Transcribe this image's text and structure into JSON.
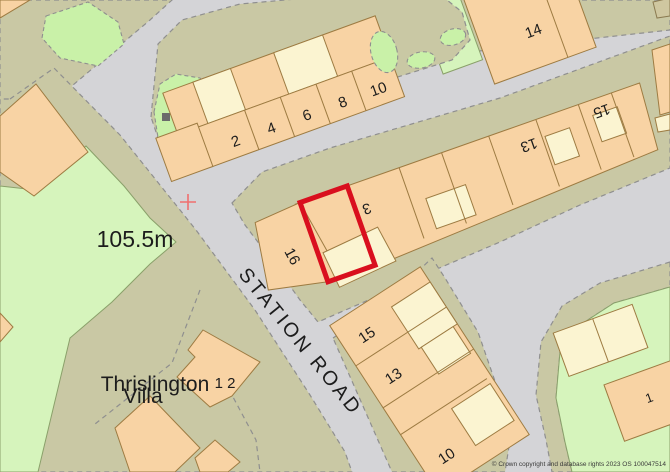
{
  "map": {
    "labels": {
      "top_terrace": [
        "2",
        "4",
        "6",
        "8",
        "10"
      ],
      "building_14": "14",
      "middle_terrace": {
        "n16": "16",
        "n3": "3",
        "n13": "13",
        "n15": "15"
      },
      "bottom_terrace": [
        "15",
        "13",
        "10"
      ],
      "right_building_1": "1",
      "spot_height": "105.5m",
      "villa_line1": "Thrislington",
      "villa_line2": "Villa",
      "building_12": "1 2",
      "road_name": "STATION ROAD",
      "copyright": "© Crown copyright and database rights 2023 OS 100047514"
    },
    "colors": {
      "road": "#d4d4d7",
      "verge": "#c9c8a4",
      "field_green": "#d6f4bc",
      "building_orange": "#f8d3a4",
      "building_pale": "#fbf4d1",
      "plot_outline_red": "#d90f1e",
      "grid_cross_red": "#f06f6f"
    }
  }
}
